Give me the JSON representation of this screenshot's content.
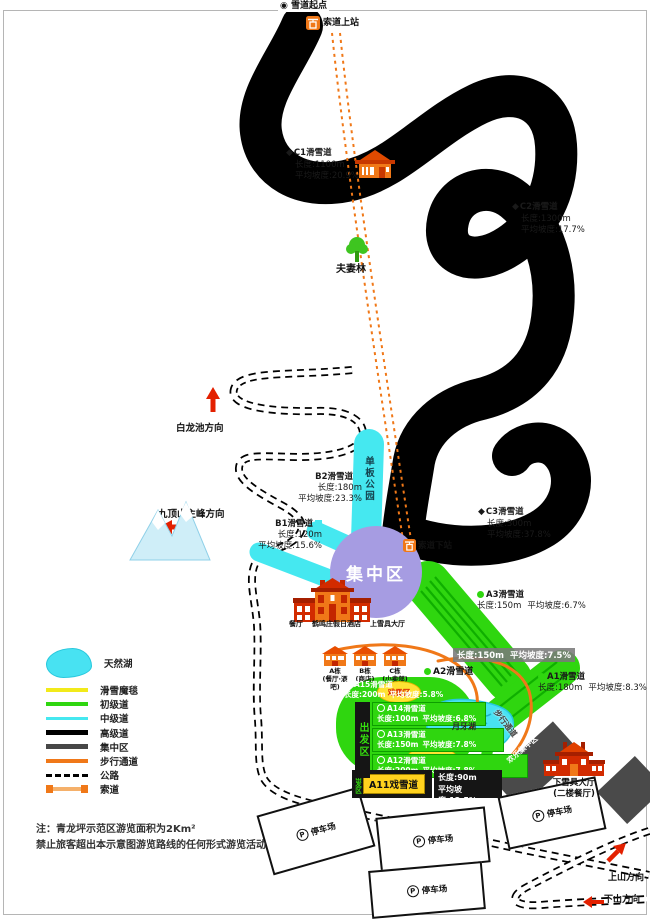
{
  "stations": {
    "start": "雪道起点",
    "ropeway_top": "索道上站",
    "ropeway_bottom": "索道下站"
  },
  "places": {
    "couple_forest": "夫妻林",
    "snowboard_park": "单板公园",
    "hub": "集中区",
    "happy_hub": "欢乐集中区",
    "crescent_lake": "月牙湖",
    "snow_play_zone": "戏雪区",
    "snow_play_garden": "戏雪园",
    "walkway": "步行通道",
    "departure_zone": "出发区",
    "parking": "停车场",
    "parking_p": "P"
  },
  "directions": {
    "white_dragon": "白龙池方向",
    "main_peak": "九顶山主峰方向",
    "uphill": "上山方向",
    "downhill": "下山方向"
  },
  "buildings": {
    "restaurant": "餐厅",
    "hotel": "鹤鸣庄假日酒店",
    "upper_gear_hall": "上雪具大厅",
    "lower_gear_hall": "下雪具大厅",
    "lower_gear_hall_sub": "(二楼餐厅)",
    "block_a": "A栋",
    "block_a_sub": "(餐厅·酒吧)",
    "block_b": "B栋",
    "block_b_sub": "(商店)",
    "block_c": "C栋",
    "block_c_sub": "(小卖部)"
  },
  "trails": {
    "c1": {
      "name": "C1滑雪道",
      "length": "长度:1100m",
      "slope": "平均坡度:20.9%"
    },
    "c2": {
      "name": "C2滑雪道",
      "length": "长度:1300m",
      "slope": "平均坡度:17.7%"
    },
    "c3": {
      "name": "C3滑雪道",
      "length": "长度:300m",
      "slope": "平均坡度:37.8%"
    },
    "b1": {
      "name": "B1滑雪道",
      "length": "长度:120m",
      "slope": "平均坡度:15.6%"
    },
    "b2": {
      "name": "B2滑雪道",
      "length": "长度:180m",
      "slope": "平均坡度:23.3%"
    },
    "a1": {
      "name": "A1滑雪道",
      "length": "长度:180m",
      "slope": "平均坡度:8.3%"
    },
    "a2": {
      "name": "A2滑雪道",
      "length": "长度:150m",
      "slope": "平均坡度:7.5%"
    },
    "a3": {
      "name": "A3滑雪道",
      "length": "长度:150m",
      "slope": "平均坡度:6.7%"
    },
    "a11": {
      "name": "A11戏雪道",
      "length": "长度:90m",
      "slope": "平均坡度:12.5%"
    },
    "a12": {
      "name": "A12滑雪道",
      "length": "长度:200m",
      "slope": "平均坡度:7.8%"
    },
    "a13": {
      "name": "A13滑雪道",
      "length": "长度:150m",
      "slope": "平均坡度:7.8%"
    },
    "a14": {
      "name": "A14滑雪道",
      "length": "长度:100m",
      "slope": "平均坡度:6.8%"
    },
    "a15": {
      "name": "A15滑雪道",
      "length": "长度:200m",
      "slope": "平均坡度:5.8%"
    }
  },
  "legend": {
    "items": [
      {
        "label": "天然湖",
        "color": "#48e2f2",
        "type": "lake"
      },
      {
        "label": "滑雪魔毯",
        "color": "#f2ea1a",
        "type": "line"
      },
      {
        "label": "初级道",
        "color": "#2fd60f",
        "type": "line"
      },
      {
        "label": "中级道",
        "color": "#45e8f0",
        "type": "line"
      },
      {
        "label": "高级道",
        "color": "#000000",
        "type": "line"
      },
      {
        "label": "集中区",
        "color": "#474747",
        "type": "line"
      },
      {
        "label": "步行通道",
        "color": "#f07818",
        "type": "line"
      },
      {
        "label": "公路",
        "color": "#000000",
        "type": "dashed"
      },
      {
        "label": "索道",
        "color": "#f07818",
        "type": "ropeway"
      }
    ]
  },
  "notes": {
    "line1": "注：青龙坪示范区游览面积为2Km²",
    "line2": "禁止旅客超出本示意图游览路线的任何形式游览活动"
  }
}
